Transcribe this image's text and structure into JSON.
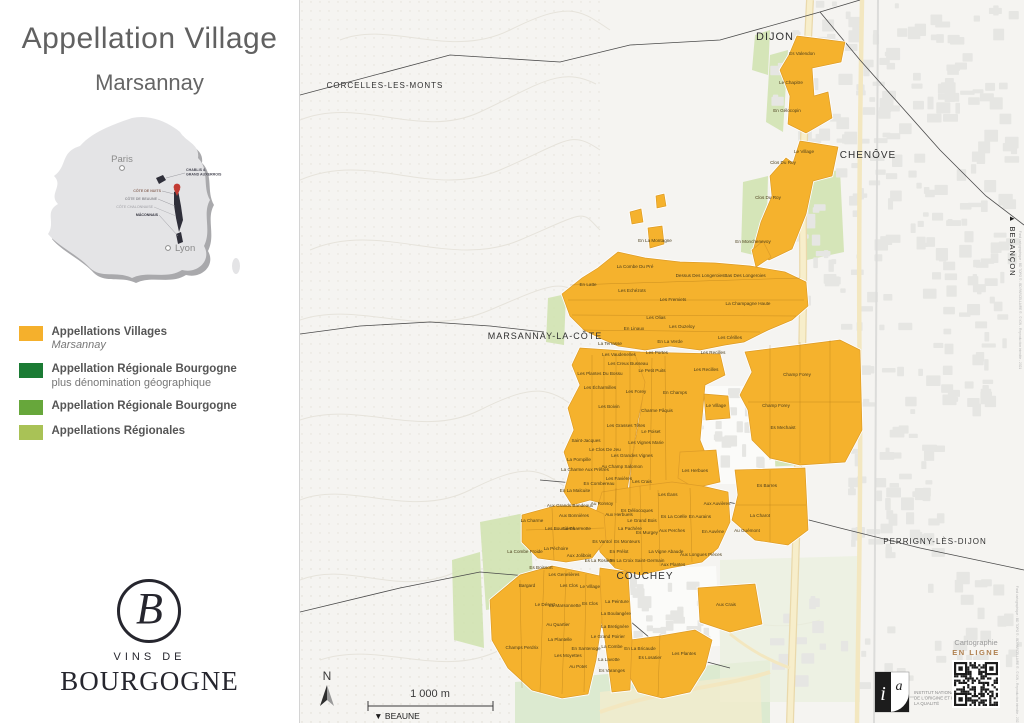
{
  "sidebar": {
    "title": "Appellation Village",
    "subtitle": "Marsannay",
    "france": {
      "paris": "Paris",
      "lyon": "Lyon",
      "regions": [
        "CHABLIS &",
        "GRAND AUXERROIS",
        "CÔTE DE NUITS",
        "CÔTE DE BEAUNE",
        "CÔTE CHALONNAISE",
        "MÂCONNAIS"
      ]
    },
    "legend": [
      {
        "color": "#F5B02C",
        "label": "Appellations Villages",
        "sub": "Marsannay",
        "italic": true
      },
      {
        "color": "#1B7B34",
        "label": "Appellation Régionale Bourgogne",
        "sub": "plus dénomination géographique",
        "italic": false
      },
      {
        "color": "#67A73B",
        "label": "Appellation Régionale Bourgogne",
        "sub": "",
        "italic": false
      },
      {
        "color": "#A9C256",
        "label": "Appellations Régionales",
        "sub": "",
        "italic": false
      }
    ],
    "logo": {
      "initial": "B",
      "line1": "VINS DE",
      "line2": "BOURGOGNE"
    }
  },
  "map": {
    "colors": {
      "village_parcel": "#F5B22D",
      "parcel_stroke": "#DD9C28",
      "green": "#CFE2AE",
      "road": "#F7EECB",
      "urban": "#E6E6E3"
    },
    "towns": [
      {
        "name": "DIJON",
        "x": 475,
        "y": 40,
        "s": 11
      },
      {
        "name": "CORCELLES-LES-MONTS",
        "x": 85,
        "y": 88,
        "s": 8
      },
      {
        "name": "CHENÔVE",
        "x": 568,
        "y": 158,
        "s": 10
      },
      {
        "name": "MARSANNAY-LA-CÔTE",
        "x": 245,
        "y": 339,
        "s": 9
      },
      {
        "name": "COUCHEY",
        "x": 345,
        "y": 579,
        "s": 10
      },
      {
        "name": "PERRIGNY-LÈS-DIJON",
        "x": 635,
        "y": 544,
        "s": 8
      }
    ],
    "parcels": [
      {
        "n": "Es Valendon",
        "x": 502,
        "y": 55
      },
      {
        "n": "Le Chapitre",
        "x": 491,
        "y": 84
      },
      {
        "n": "En Gélocopin",
        "x": 487,
        "y": 112
      },
      {
        "n": "Le Village",
        "x": 504,
        "y": 153
      },
      {
        "n": "Clos Du Roy",
        "x": 483,
        "y": 164
      },
      {
        "n": "Clos Du Roy",
        "x": 468,
        "y": 199
      },
      {
        "n": "En Monchenevoy",
        "x": 453,
        "y": 243
      },
      {
        "n": "En La Montagne",
        "x": 355,
        "y": 242
      },
      {
        "n": "La Combe Du Pré",
        "x": 335,
        "y": 268
      },
      {
        "n": "En Latte",
        "x": 288,
        "y": 286
      },
      {
        "n": "Les Echézots",
        "x": 332,
        "y": 292
      },
      {
        "n": "Dessus Des Longeroies",
        "x": 400,
        "y": 277
      },
      {
        "n": "Bas Des Longeroies",
        "x": 445,
        "y": 277
      },
      {
        "n": "La Champagne Haute",
        "x": 448,
        "y": 305
      },
      {
        "n": "Les Fremiets",
        "x": 373,
        "y": 301
      },
      {
        "n": "Les Olias",
        "x": 356,
        "y": 319
      },
      {
        "n": "Les Ouzeloy",
        "x": 382,
        "y": 328
      },
      {
        "n": "En Linaux",
        "x": 334,
        "y": 330
      },
      {
        "n": "En La Verde",
        "x": 370,
        "y": 343
      },
      {
        "n": "Les Portes",
        "x": 357,
        "y": 354
      },
      {
        "n": "Les Cérilles",
        "x": 430,
        "y": 339
      },
      {
        "n": "Les Recilles",
        "x": 413,
        "y": 354
      },
      {
        "n": "Les Recilles",
        "x": 406,
        "y": 371
      },
      {
        "n": "La Terrasse",
        "x": 310,
        "y": 345
      },
      {
        "n": "Les Vaudenelles",
        "x": 319,
        "y": 356
      },
      {
        "n": "Les Creux Busseau",
        "x": 328,
        "y": 365
      },
      {
        "n": "Le Petit Puits",
        "x": 352,
        "y": 372
      },
      {
        "n": "Les Plantes Du Bossu",
        "x": 300,
        "y": 375
      },
      {
        "n": "Les Écharmilles",
        "x": 300,
        "y": 389
      },
      {
        "n": "Les Forey",
        "x": 336,
        "y": 393
      },
      {
        "n": "En Champs",
        "x": 375,
        "y": 394
      },
      {
        "n": "Le Village",
        "x": 416,
        "y": 407
      },
      {
        "n": "Charme Pâquis",
        "x": 357,
        "y": 412
      },
      {
        "n": "Les Boivin",
        "x": 309,
        "y": 408
      },
      {
        "n": "Les Grasses Têtes",
        "x": 326,
        "y": 427
      },
      {
        "n": "Le Poiset",
        "x": 351,
        "y": 433
      },
      {
        "n": "Saint-Jacques",
        "x": 286,
        "y": 442
      },
      {
        "n": "Les Vignes Marie",
        "x": 346,
        "y": 444
      },
      {
        "n": "Le Clos De Jeu",
        "x": 305,
        "y": 451
      },
      {
        "n": "Les Grandes Vignes",
        "x": 332,
        "y": 457
      },
      {
        "n": "La Pompille",
        "x": 279,
        "y": 461
      },
      {
        "n": "Au Champ Salomon",
        "x": 322,
        "y": 468
      },
      {
        "n": "La Charme Aux Prêtres",
        "x": 285,
        "y": 471
      },
      {
        "n": "Les Favières",
        "x": 319,
        "y": 480
      },
      {
        "n": "En Combereau",
        "x": 299,
        "y": 485
      },
      {
        "n": "Les Crais",
        "x": 342,
        "y": 483
      },
      {
        "n": "Les Herbues",
        "x": 395,
        "y": 472
      },
      {
        "n": "Les Éans",
        "x": 368,
        "y": 496
      },
      {
        "n": "En La Malcuite",
        "x": 275,
        "y": 492
      },
      {
        "n": "Aux Grands Bandeaux",
        "x": 270,
        "y": 507
      },
      {
        "n": "Au Ronsoy",
        "x": 302,
        "y": 505
      },
      {
        "n": "Aux Bonnières",
        "x": 274,
        "y": 517
      },
      {
        "n": "Aux Herbuels",
        "x": 319,
        "y": 516
      },
      {
        "n": "Es Déliocoques",
        "x": 337,
        "y": 512
      },
      {
        "n": "Le Grand Bois",
        "x": 342,
        "y": 522
      },
      {
        "n": "La Pachère",
        "x": 330,
        "y": 530
      },
      {
        "n": "Es Murgey",
        "x": 347,
        "y": 534
      },
      {
        "n": "Es La Coëlle",
        "x": 374,
        "y": 518
      },
      {
        "n": "Aux Perches",
        "x": 372,
        "y": 532
      },
      {
        "n": "En Aurains",
        "x": 400,
        "y": 518
      },
      {
        "n": "Aux Auvières",
        "x": 417,
        "y": 505
      },
      {
        "n": "En Auvène",
        "x": 413,
        "y": 533
      },
      {
        "n": "Au Guémont",
        "x": 447,
        "y": 532
      },
      {
        "n": "Es Barres",
        "x": 467,
        "y": 487
      },
      {
        "n": "La Charot",
        "x": 460,
        "y": 517
      },
      {
        "n": "Champ Forey",
        "x": 497,
        "y": 376
      },
      {
        "n": "Champ Forey",
        "x": 476,
        "y": 407
      },
      {
        "n": "Es Mechaist",
        "x": 483,
        "y": 429
      },
      {
        "n": "La Charmotte",
        "x": 277,
        "y": 530
      },
      {
        "n": "Es Vantol",
        "x": 302,
        "y": 543
      },
      {
        "n": "Es Monteurs",
        "x": 327,
        "y": 543
      },
      {
        "n": "En Prélot",
        "x": 319,
        "y": 553
      },
      {
        "n": "Es La Rosière",
        "x": 299,
        "y": 562
      },
      {
        "n": "En La Croix Saint-Germain",
        "x": 337,
        "y": 562
      },
      {
        "n": "La Vigne Abaude",
        "x": 366,
        "y": 553
      },
      {
        "n": "Aux Longues Pièces",
        "x": 401,
        "y": 556
      },
      {
        "n": "Aux Plantes",
        "x": 373,
        "y": 566
      },
      {
        "n": "Aux Crais",
        "x": 426,
        "y": 606
      },
      {
        "n": "La Charme",
        "x": 232,
        "y": 522
      },
      {
        "n": "Les Bourrières",
        "x": 260,
        "y": 530
      },
      {
        "n": "La Combe Froide",
        "x": 225,
        "y": 553
      },
      {
        "n": "La Péchoire",
        "x": 256,
        "y": 550
      },
      {
        "n": "Aux Jolibois",
        "x": 279,
        "y": 557
      },
      {
        "n": "Es Boissort",
        "x": 241,
        "y": 569
      },
      {
        "n": "Les Genelières",
        "x": 264,
        "y": 576
      },
      {
        "n": "Bargard",
        "x": 227,
        "y": 587
      },
      {
        "n": "Les Clos",
        "x": 269,
        "y": 587
      },
      {
        "n": "Le Village",
        "x": 290,
        "y": 588
      },
      {
        "n": "Le Désert",
        "x": 245,
        "y": 606
      },
      {
        "n": "La Marsonnette",
        "x": 265,
        "y": 607
      },
      {
        "n": "Es Clos",
        "x": 290,
        "y": 605
      },
      {
        "n": "La Peinture",
        "x": 317,
        "y": 603
      },
      {
        "n": "Au Quartier",
        "x": 258,
        "y": 626
      },
      {
        "n": "La Boulangère",
        "x": 316,
        "y": 615
      },
      {
        "n": "La Bretignère",
        "x": 315,
        "y": 628
      },
      {
        "n": "Le Grand Poirier",
        "x": 308,
        "y": 638
      },
      {
        "n": "La Plantelle",
        "x": 260,
        "y": 641
      },
      {
        "n": "Champs Perdrix",
        "x": 222,
        "y": 649
      },
      {
        "n": "En Santenoge",
        "x": 286,
        "y": 650
      },
      {
        "n": "Les Moyettes",
        "x": 268,
        "y": 657
      },
      {
        "n": "La Combe",
        "x": 312,
        "y": 648
      },
      {
        "n": "En La Bricaude",
        "x": 340,
        "y": 650
      },
      {
        "n": "La Lavotte",
        "x": 309,
        "y": 661
      },
      {
        "n": "Es Losatier",
        "x": 350,
        "y": 659
      },
      {
        "n": "Les Plantes",
        "x": 384,
        "y": 655
      },
      {
        "n": "Au Potet",
        "x": 278,
        "y": 668
      },
      {
        "n": "Es Varanges",
        "x": 312,
        "y": 672
      }
    ],
    "north_label": "N",
    "scale_label": "1 000 m",
    "beaune": "▼ BEAUNE",
    "besancon": "▲ BESANÇON",
    "credits": "Fond cartographique : BD TOPO ® - BD PARCELLAIRE ® - © IGN - Reproduction interdite - 2021",
    "inao_lines": [
      "INSTITUT NATIONAL",
      "DE L'ORIGINE ET DE",
      "LA QUALITÉ"
    ],
    "carto": {
      "line1": "Cartographie",
      "line2": "EN LIGNE"
    }
  }
}
